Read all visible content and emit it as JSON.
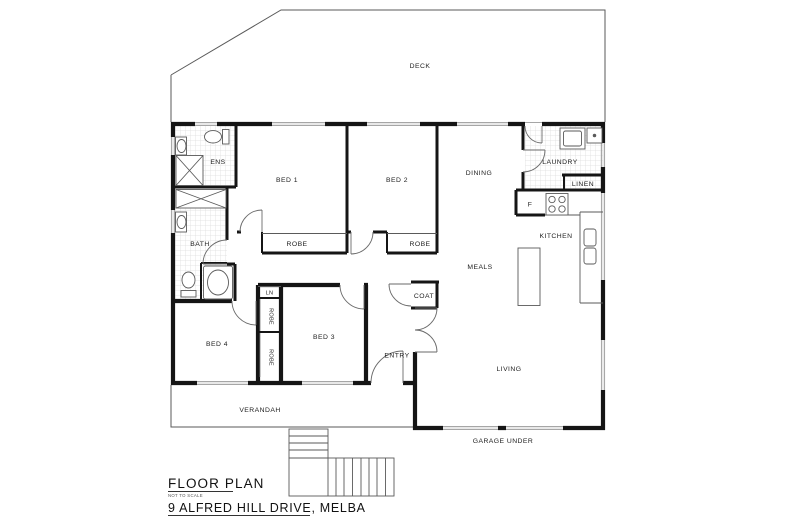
{
  "plan": {
    "rooms": {
      "deck": "DECK",
      "ens": "ENS",
      "bed1": "BED 1",
      "bed2": "BED 2",
      "dining": "DINING",
      "laundry": "LAUNDRY",
      "linen": "LINEN",
      "fridge": "F",
      "kitchen": "KITCHEN",
      "bath": "BATH",
      "robe_bed1": "ROBE",
      "robe_bed2": "ROBE",
      "meals": "MEALS",
      "coat": "COAT",
      "linen_small": "LN",
      "robe_bed4_upper": "ROBE",
      "robe_bed4_lower": "ROBE",
      "bed4": "BED 4",
      "bed3": "BED 3",
      "entry": "ENTRY",
      "living": "LIVING",
      "verandah": "VERANDAH",
      "garage": "GARAGE UNDER"
    },
    "title_block": {
      "title": "FLOOR PLAN",
      "scale_note": "NOT TO SCALE",
      "address": "9 ALFRED HILL DRIVE, MELBA"
    },
    "colors": {
      "wall": "#151515",
      "thin_line": "#5a5a5a",
      "window_line": "#9a9a9a",
      "tile_line": "#dcdcdc",
      "text": "#222222"
    }
  }
}
